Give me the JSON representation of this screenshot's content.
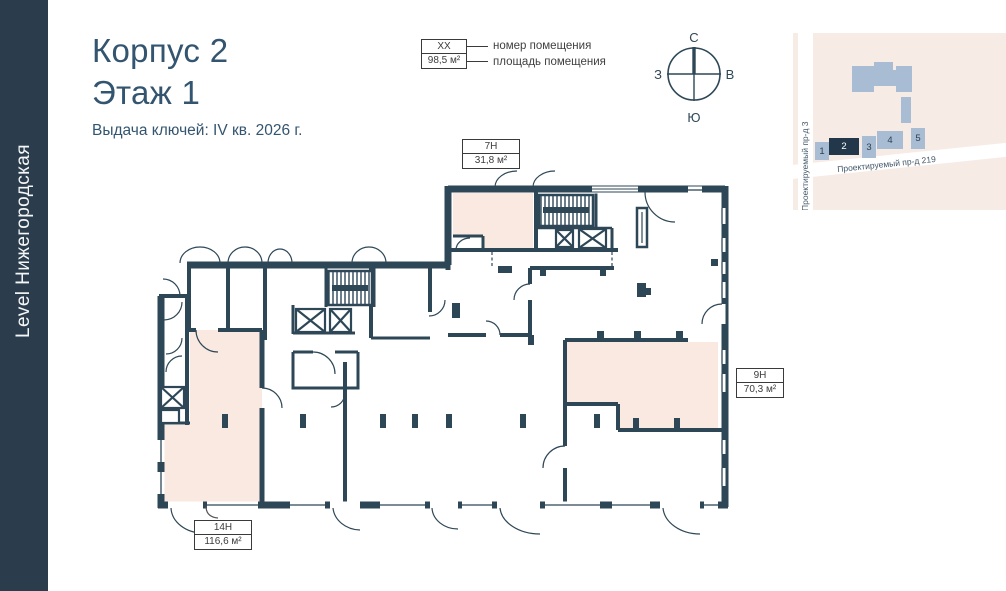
{
  "sidebar": {
    "brand": "Level Нижегородская"
  },
  "header": {
    "title_line1": "Корпус 2",
    "title_line2": "Этаж 1",
    "subtitle": "Выдача ключей: IV кв. 2026 г."
  },
  "legend": {
    "number_example": "XX",
    "area_example": "98,5 м²",
    "number_label": "номер помещения",
    "area_label": "площадь помещения"
  },
  "compass": {
    "north": "С",
    "south": "Ю",
    "west": "З",
    "east": "В"
  },
  "minimap": {
    "street_vertical": "Проектируемый пр-д 3",
    "street_diagonal": "Проектируемый пр-д 219",
    "buildings": [
      {
        "label": "1",
        "highlighted": false
      },
      {
        "label": "2",
        "highlighted": true
      },
      {
        "label": "3",
        "highlighted": false
      },
      {
        "label": "4",
        "highlighted": false
      },
      {
        "label": "5",
        "highlighted": false
      }
    ]
  },
  "rooms": [
    {
      "number": "7Н",
      "area": "31,8 м²"
    },
    {
      "number": "9Н",
      "area": "70,3 м²"
    },
    {
      "number": "14Н",
      "area": "116,6 м²"
    }
  ],
  "colors": {
    "wall": "#2e4757",
    "room_fill": "#f9e9e1",
    "sidebar_bg": "#2b3d4c",
    "title_text": "#335570",
    "map_bg": "#f7ebe6",
    "map_building": "#a8bcd3",
    "map_building_active": "#22374a"
  }
}
